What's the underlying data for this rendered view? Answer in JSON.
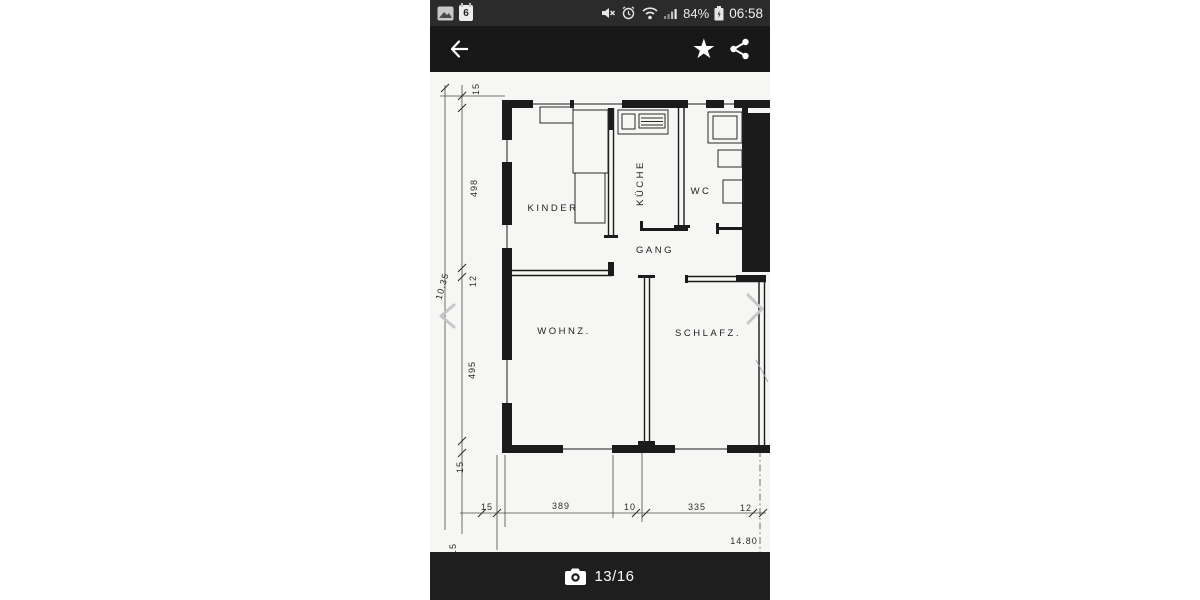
{
  "status_bar": {
    "time": "06:58",
    "battery_percent": "84%",
    "calendar_day": "6",
    "icons": [
      "photo-icon",
      "calendar-icon",
      "mute-icon",
      "alarm-icon",
      "wifi-icon",
      "signal-icon",
      "battery-charging-icon"
    ]
  },
  "toolbar": {
    "star": "★",
    "icons": [
      "back-arrow-icon",
      "star-icon",
      "share-icon"
    ]
  },
  "viewer": {
    "counter": "13/16",
    "icons": [
      "camera-icon",
      "chevron-left-icon",
      "chevron-right-icon"
    ]
  },
  "plan": {
    "rooms": {
      "kinder": "KINDER",
      "kueche": "KÜCHE",
      "wc": "WC",
      "gang": "GANG",
      "wohnz": "WOHNZ.",
      "schlafz": "SCHLAFZ."
    },
    "dims_left": {
      "top15": "15",
      "h498": "498",
      "m12": "12",
      "h495": "495",
      "bottom15": "15",
      "total": "10.35"
    },
    "dims_bottom": {
      "w15": "15",
      "w389": "389",
      "w10": "10",
      "w335": "335",
      "w12": "12",
      "total": "14.80",
      "cut15": "15"
    }
  },
  "colors": {
    "statusbar_bg": "#2b2b2b",
    "toolbar_bg": "#181818",
    "bottombar_bg": "#1e1e1e",
    "paper": "#f6f6f4",
    "ink": "#1b1b1b"
  }
}
